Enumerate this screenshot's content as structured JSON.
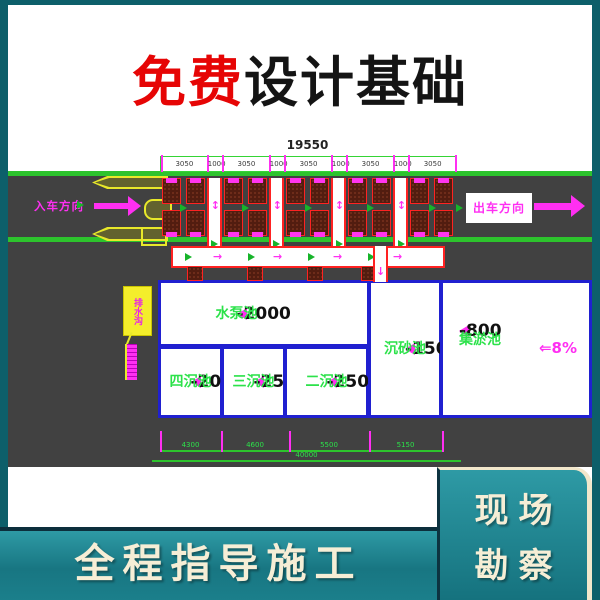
{
  "title": {
    "highlight": "免费",
    "rest": "设计基础"
  },
  "colors": {
    "background_teal": "#0d5f6a",
    "band_teal": "#1b7f8b",
    "cream": "#f6eed6",
    "title_red": "#e60505",
    "asphalt": "#414141",
    "lane_green": "#2dc32d",
    "magenta": "#ff2ff2",
    "grate_red": "#ff2222",
    "pool_blue": "#2020d0",
    "text_green": "#2ce24a"
  },
  "drawing": {
    "dim_top": {
      "total": "19550",
      "segments": [
        "3050",
        "1000",
        "3050",
        "1000",
        "3050",
        "1000",
        "3050",
        "1000",
        "3050"
      ]
    },
    "entry_label": "入车方向",
    "exit_label": "出车方向",
    "callout_label": "排水沟",
    "pools": [
      {
        "id": "pump",
        "level": "-2000",
        "name": "水泵池"
      },
      {
        "id": "four",
        "level": "-2000",
        "name": "四沉池"
      },
      {
        "id": "three",
        "level": "-2500",
        "name": "三沉池"
      },
      {
        "id": "two",
        "level": "-2500",
        "name": "二沉池"
      },
      {
        "id": "sand",
        "level": "-1500",
        "name": "沉砂池"
      },
      {
        "id": "silt",
        "level": "-800",
        "name": "集淤池"
      }
    ],
    "slope": {
      "arrow": "⇐",
      "value": "8%"
    },
    "dim_bottom": {
      "segments": [
        "4300",
        "4600",
        "5500",
        "5150"
      ],
      "total": "40000"
    }
  },
  "footer": {
    "left_banner": "全程指导施工",
    "right_box_lines": [
      "现场",
      "勘察"
    ]
  }
}
